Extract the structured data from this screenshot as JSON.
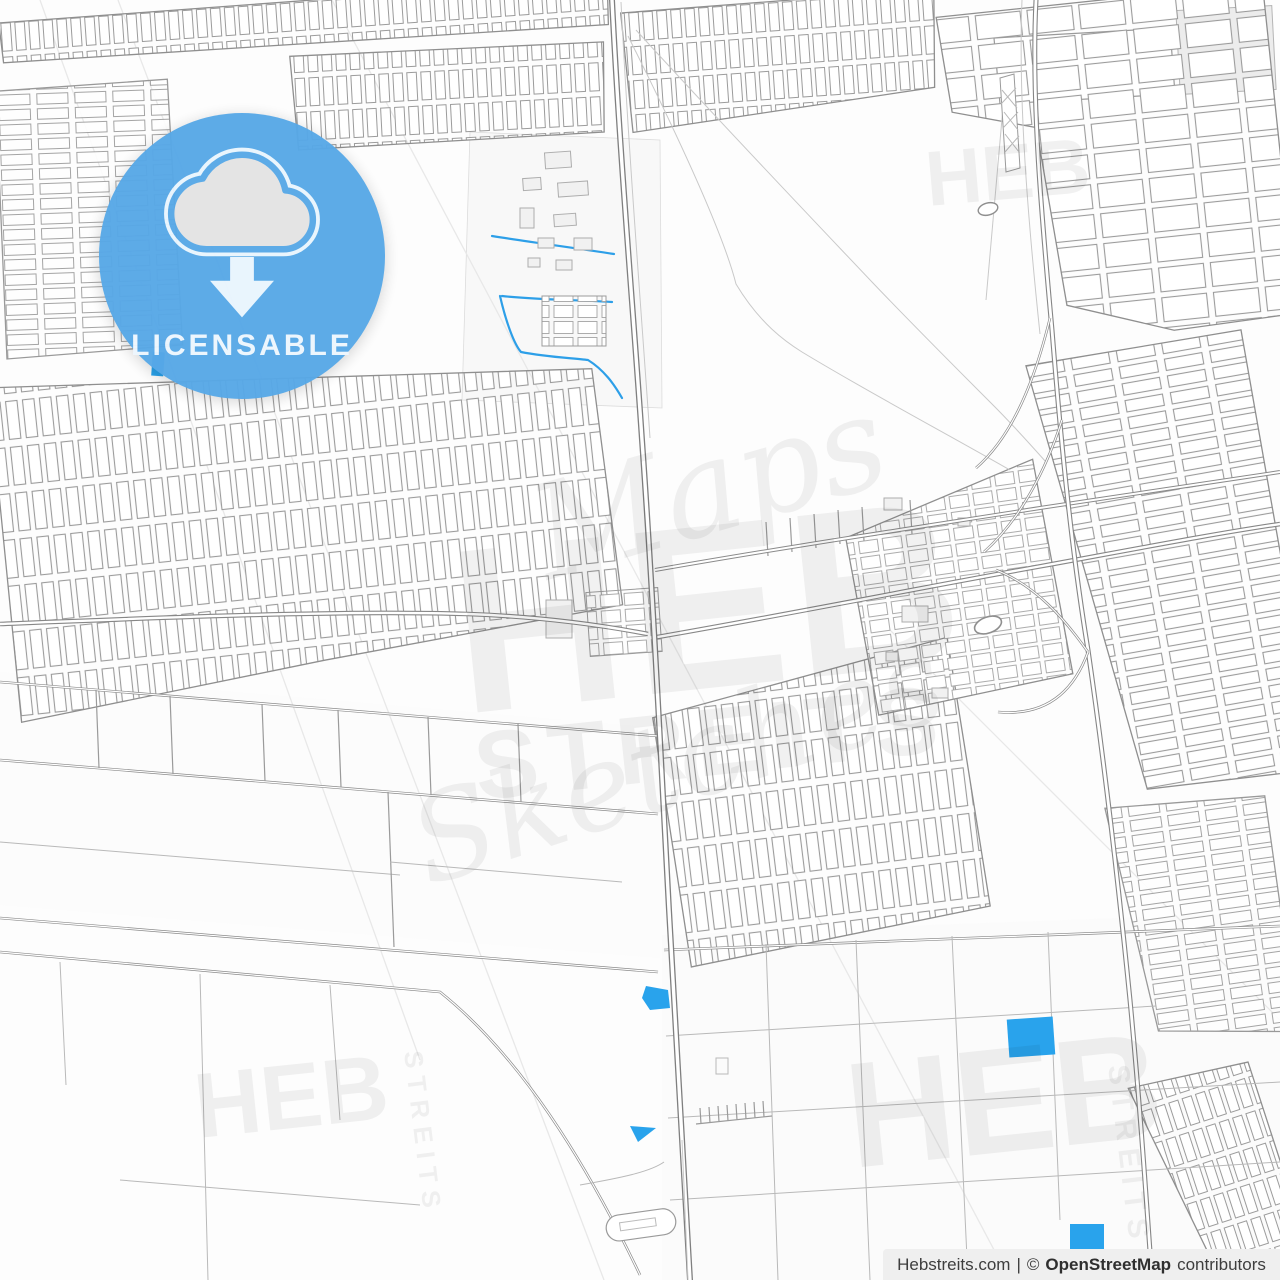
{
  "badge": {
    "label": "LICENSABLE",
    "icon": "cloud-download-icon",
    "color": "#57A8E7",
    "text_color": "#EDF6FE"
  },
  "watermarks": {
    "script_top": "Maps",
    "brand": "HEB",
    "brand_sub": "STREITS",
    "script_bottom": "Sketches",
    "corner": "HEB",
    "vertical": "STREITS"
  },
  "footer": {
    "site": "Hebstreits.com",
    "divider": "|",
    "copyright": "©",
    "osm": "OpenStreetMap",
    "suffix": "contributors"
  },
  "theme": {
    "badge_blue": "#57A8E7",
    "badge_text": "#EDF6FE",
    "cloud_fill": "#E4E4E4",
    "icon_light": "#E9F5FE",
    "water_blue": "#29A3EC",
    "road_gray": "#858585",
    "grid_gray": "#9B9B9B",
    "footer_bg": "#EFEFEF",
    "footer_text": "#3E3E3E",
    "background": "#FDFDFD"
  }
}
